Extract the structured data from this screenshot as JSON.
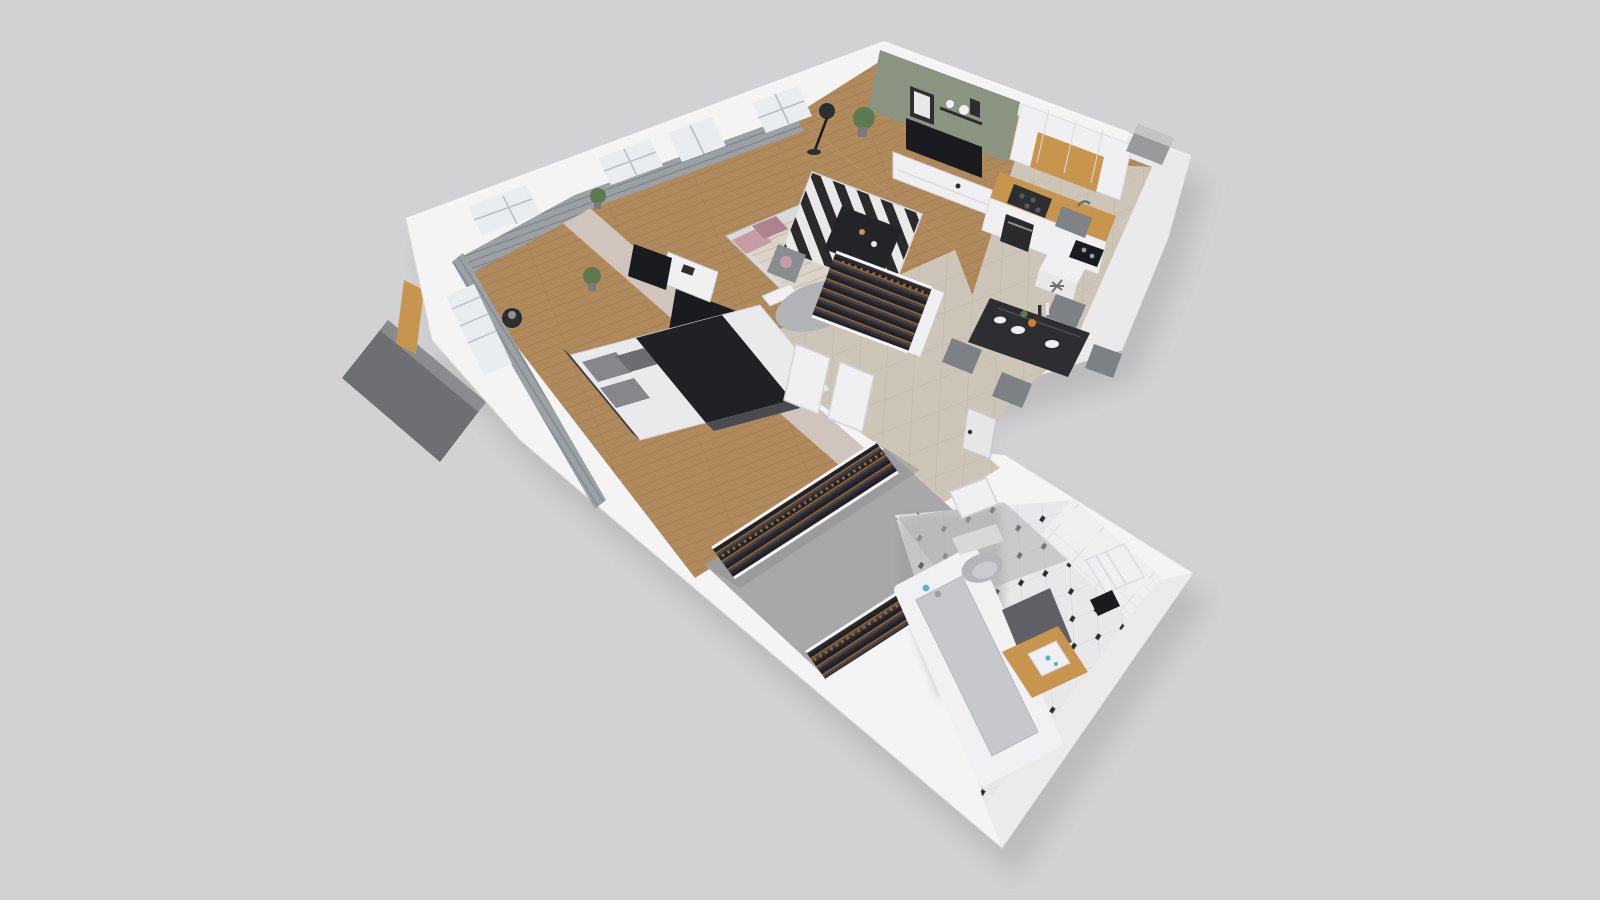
{
  "scene": {
    "title": "3D isometric cutaway floor plan render of an apartment",
    "style": "dollhouse axonometric, white cut walls on gray backdrop",
    "background": "#d2d2d4",
    "rooms": {
      "living": {
        "label": "Living room and kitchen",
        "floor": "wood planks + beige tile by kitchen",
        "features": [
          "sage green accent wall",
          "framed pictures",
          "wall shelf",
          "flat TV",
          "white media console",
          "potted plant",
          "black floor lamp",
          "black and white striped rug",
          "dark coffee table",
          "armchair",
          "dining table with tableware",
          "four gray chairs",
          "white kitchen cabinets with wood band",
          "oven",
          "cooktop",
          "sink",
          "utility block with vent rosette",
          "ventilation shaft"
        ]
      },
      "kids": {
        "label": "Small bedroom",
        "floor": "wood planks",
        "features": [
          "daybed with patterned duvet",
          "pink pillows",
          "green pillow",
          "round gray rug",
          "white desk",
          "wall TV",
          "gray curtains",
          "plant",
          "window and balcony door"
        ]
      },
      "master": {
        "label": "Master bedroom",
        "floor": "wood planks",
        "features": [
          "double bed with black duvet",
          "gray pillows",
          "black side table",
          "wall TV on taupe wall",
          "gray curtains",
          "plant",
          "two windows",
          "balcony slab outside"
        ]
      },
      "hall": {
        "label": "Hallway",
        "floor": "beige tile",
        "features": [
          "open wardrobe with clothes",
          "two open white doors",
          "entrance door"
        ]
      },
      "closet": {
        "label": "Walk-in closet",
        "floor": "gray",
        "features": [
          "two clothes racks with hangers"
        ]
      },
      "bath": {
        "label": "Bathroom",
        "floor": "octagon tile with black dots",
        "features": [
          "white tiled walls",
          "bathtub",
          "wall hung toilet",
          "dark bath mat",
          "wood vanity with white basin",
          "washing machine",
          "black wall unit",
          "blue toiletries"
        ]
      }
    },
    "palette": {
      "bg": "#d2d2d4",
      "shadow": "#a9a9ac",
      "wallWhite": "#f4f4f5",
      "wallShade": "#e8e8ea",
      "wallTaupe": "#cfc5bd",
      "greenWall": "#8b9381",
      "woodFloor": "#b08a5c",
      "woodDark": "#8f6f45",
      "tileBeige": "#cdc6b8",
      "tileLine": "#bdb6a8",
      "closetFloor": "#a8a8ab",
      "bathFloor": "#e8e8ea",
      "tileWhite": "#efeff1",
      "curtain": "#9ba1a5",
      "curtainDark": "#7e8489",
      "dark": "#2d2e31",
      "tv": "#1a1b1e",
      "rugDark": "#2a2a2d",
      "rugLight": "#e9e9ea",
      "grayRug": "#b2b3b6",
      "bedDuvet": "#202125",
      "bedSheet": "#eaeaec",
      "pillowGray": "#85878b",
      "pinkPillow": "#c79ca4",
      "pinkDark": "#ab8490",
      "greenPillow": "#7e8a64",
      "chairGray": "#7d8084",
      "tableDark": "#2c2e31",
      "vanityWood": "#c8954f",
      "plant": "#5c7a4e",
      "furnWhite": "#f0f0f2",
      "fixtureGray": "#b3b5b8",
      "tubInner": "#c7c8cb",
      "blue": "#5fb3c9",
      "hanger": "#9c6a33",
      "clothes1": "#202026",
      "clothes2": "#44444c",
      "clothes3": "#2b2b31",
      "windowGlass": "#e9edf0",
      "frameGray": "#b9bfc4"
    }
  }
}
